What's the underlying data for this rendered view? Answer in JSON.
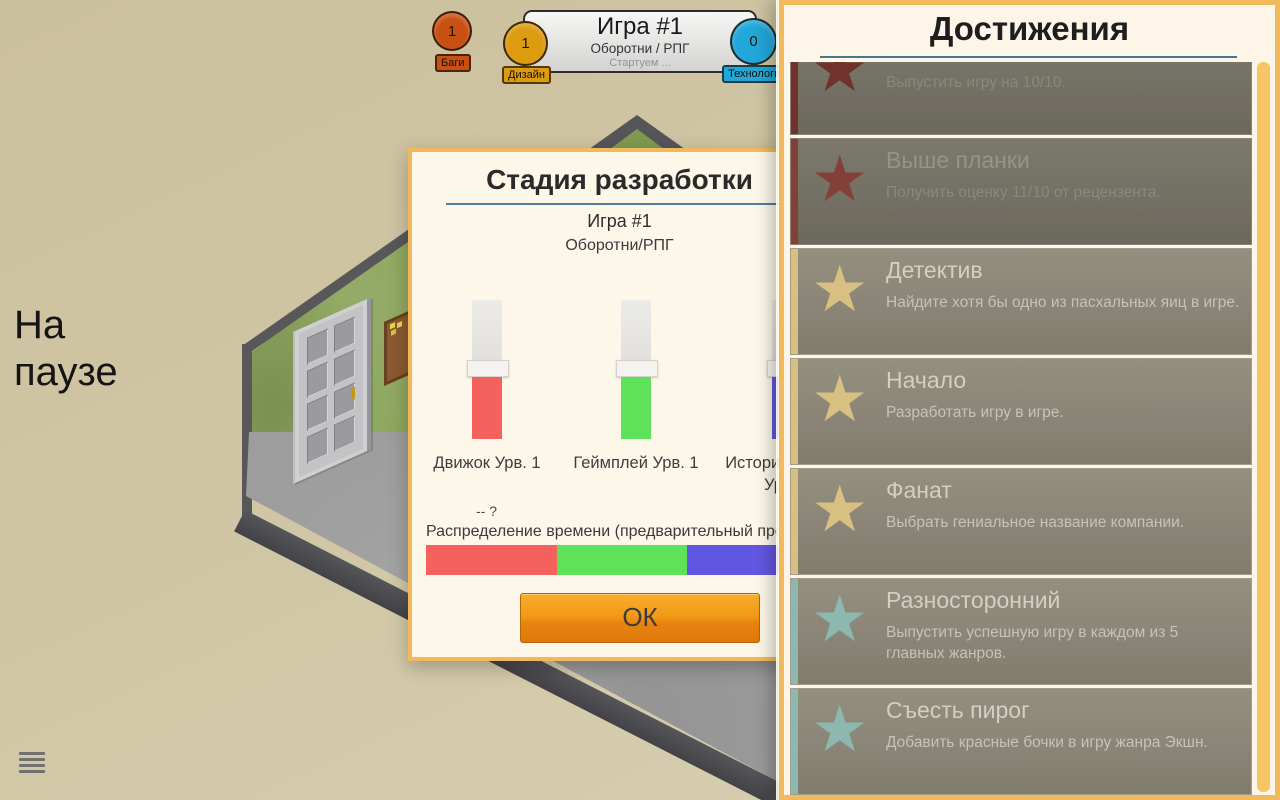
{
  "theme": {
    "background_tan": "#d0c6a5",
    "panel_border_orange": "#f2b95c",
    "rule_blue": "#4e7f9e",
    "scrollbar_orange": "#f8c566",
    "ok_gradient_top": "#f9ae2b",
    "ok_gradient_bottom": "#e07a0c"
  },
  "hud": {
    "pause_text": "На паузе",
    "menu_icon": "hamburger",
    "game_info": {
      "title": "Игра #1",
      "subtitle": "Оборотни / РПГ",
      "status": "Стартуем ...",
      "badges": [
        {
          "name": "bugs",
          "count": "1",
          "label": "Баги",
          "color": "#c85012"
        },
        {
          "name": "design",
          "count": "1",
          "label": "Дизайн",
          "color": "#dd9b10"
        },
        {
          "name": "tech",
          "count": "0",
          "label": "Технология",
          "color": "#21a7d9"
        }
      ]
    }
  },
  "dialog": {
    "title": "Стадия разработки",
    "game_name": "Игра #1",
    "game_type": "Оборотни/РПГ",
    "sliders": [
      {
        "label": "Движок Урв. 1",
        "label2": "",
        "color": "#f5615d"
      },
      {
        "label": "Геймплей Урв. 1",
        "label2": "",
        "color": "#5de25a"
      },
      {
        "label": "История/Квесты",
        "label2": "Урв. 1",
        "color": "#6257e2"
      }
    ],
    "hint": "-- ?",
    "allocation_label": "Распределение времени (предварительный просмотр)",
    "ok_label": "ОК"
  },
  "achievements": {
    "title": "Достижения",
    "items": [
      {
        "title": "",
        "desc": "Выпустить игру на 10/10.",
        "star_color": "#8a3a32",
        "locked": true
      },
      {
        "title": "Выше планки",
        "desc": "Получить оценку 11/10 от рецензента.",
        "star_color": "#a34a40",
        "locked": true
      },
      {
        "title": "Детектив",
        "desc": "Найдите хотя бы одно из пасхальных яиц в игре.",
        "star_color": "#d8c083",
        "locked": false
      },
      {
        "title": "Начало",
        "desc": "Разработать игру в игре.",
        "star_color": "#d8c083",
        "locked": false
      },
      {
        "title": "Фанат",
        "desc": "Выбрать гениальное название компании.",
        "star_color": "#d8c083",
        "locked": false
      },
      {
        "title": "Разносторонний",
        "desc": "Выпустить успешную игру в каждом из 5 главных жанров.",
        "star_color": "#8cb8b0",
        "locked": false
      },
      {
        "title": "Съесть пирог",
        "desc": "Добавить красные бочки в игру жанра Экшн.",
        "star_color": "#8cb8b0",
        "locked": false
      }
    ]
  }
}
